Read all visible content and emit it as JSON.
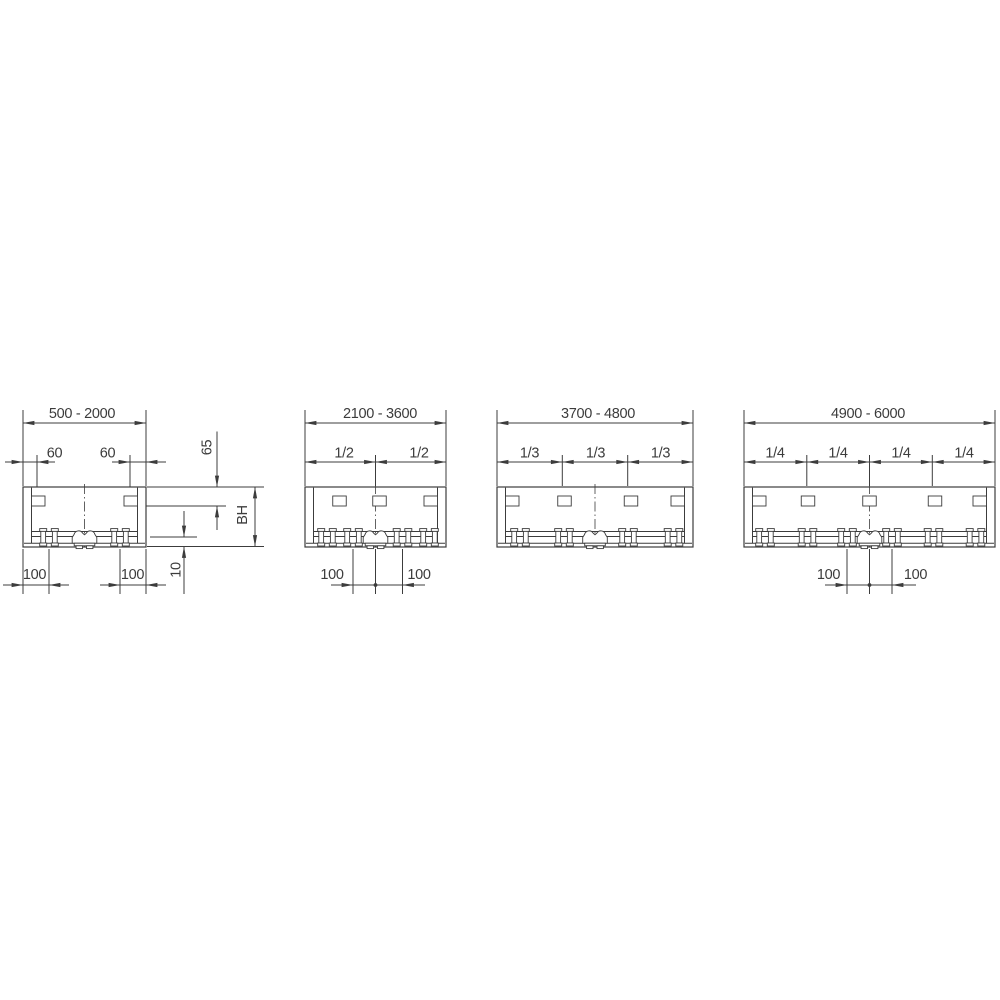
{
  "diagram": {
    "type": "technical-drawing",
    "line_color": "#3c3c3c",
    "background": "#ffffff",
    "panels": [
      {
        "width_range": "500 - 2000",
        "top_offset_left": "60",
        "top_offset_right": "60",
        "bottom_offset_left": "100",
        "bottom_offset_right": "100",
        "side_top_offset": "65",
        "side_height": "BH",
        "side_bottom_lip": "10"
      },
      {
        "width_range": "2100 - 3600",
        "fractions": [
          "1/2",
          "1/2"
        ],
        "bottom_offset_left": "100",
        "bottom_offset_right": "100"
      },
      {
        "width_range": "3700 - 4800",
        "fractions": [
          "1/3",
          "1/3",
          "1/3"
        ]
      },
      {
        "width_range": "4900 - 6000",
        "fractions": [
          "1/4",
          "1/4",
          "1/4",
          "1/4"
        ],
        "bottom_offset_left": "100",
        "bottom_offset_right": "100"
      }
    ]
  }
}
